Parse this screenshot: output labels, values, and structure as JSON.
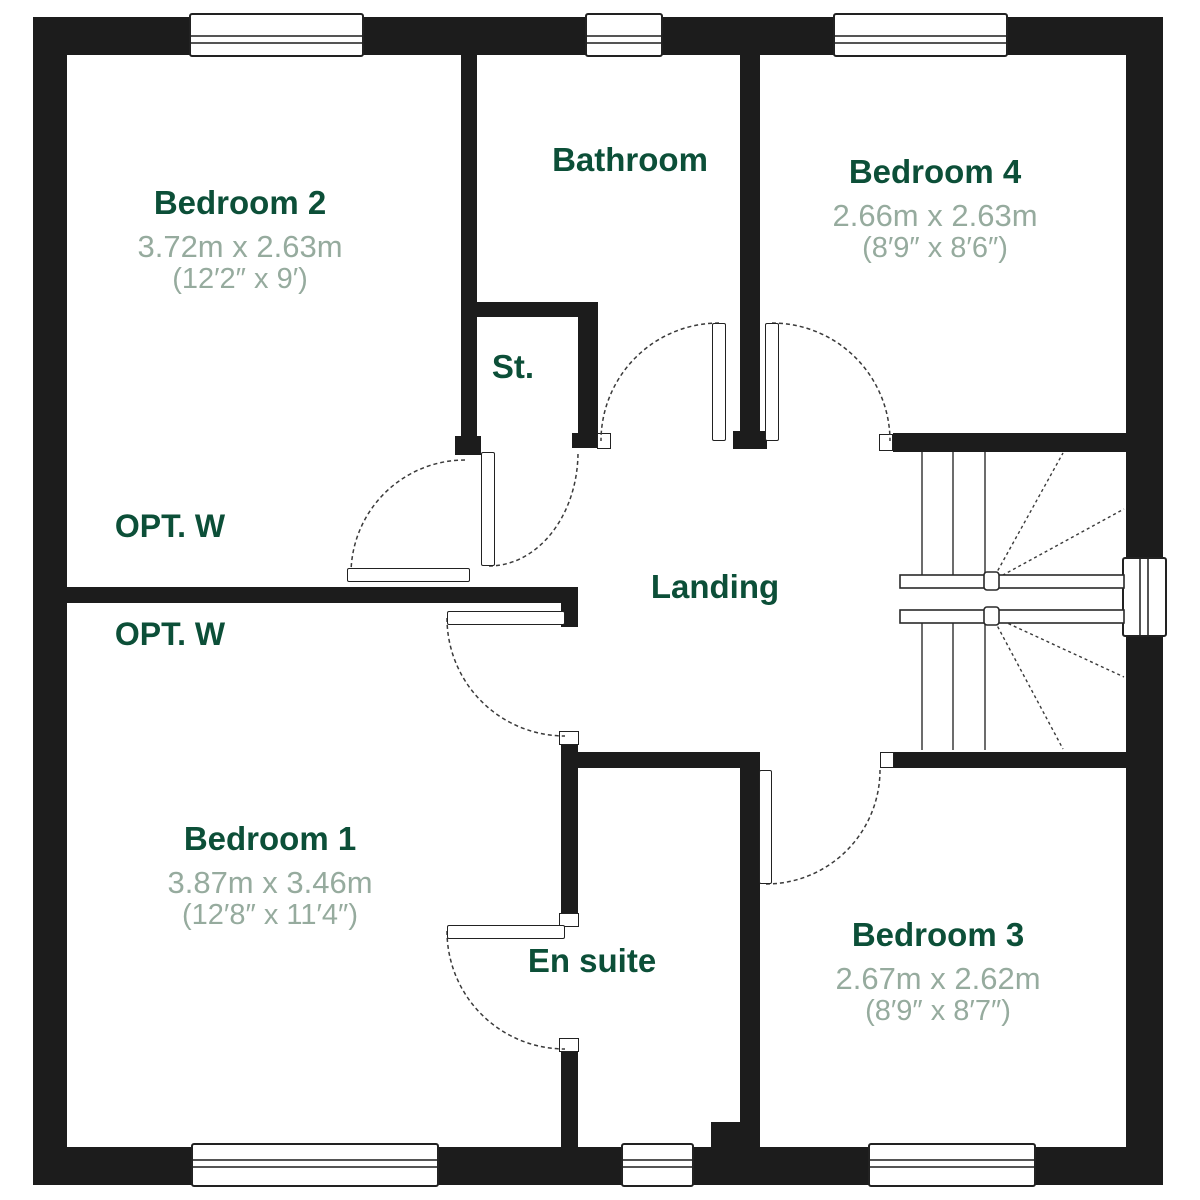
{
  "plan": {
    "floor_name": "First Floor",
    "rooms": [
      {
        "id": "bedroom2",
        "name": "Bedroom 2",
        "metric": "3.72m x 2.63m",
        "imperial": "(12′2″ x 9′)"
      },
      {
        "id": "bathroom",
        "name": "Bathroom"
      },
      {
        "id": "bedroom4",
        "name": "Bedroom 4",
        "metric": "2.66m x 2.63m",
        "imperial": "(8′9″ x 8′6″)"
      },
      {
        "id": "storage",
        "name": "St."
      },
      {
        "id": "landing",
        "name": "Landing"
      },
      {
        "id": "bedroom1",
        "name": "Bedroom 1",
        "metric": "3.87m x 3.46m",
        "imperial": "(12′8″ x 11′4″)"
      },
      {
        "id": "ensuite",
        "name": "En suite"
      },
      {
        "id": "bedroom3",
        "name": "Bedroom 3",
        "metric": "2.67m x 2.62m",
        "imperial": "(8′9″ x 8′7″)"
      }
    ],
    "annotations": [
      {
        "id": "opt-wardrobe-bedroom2",
        "text": "OPT. W"
      },
      {
        "id": "opt-wardrobe-bedroom1",
        "text": "OPT. W"
      }
    ],
    "colors": {
      "wall": "#1c1c1c",
      "room_label": "#0c4f38",
      "dimension_label": "#96ab9e",
      "thin_line": "#3a3a3a"
    }
  }
}
